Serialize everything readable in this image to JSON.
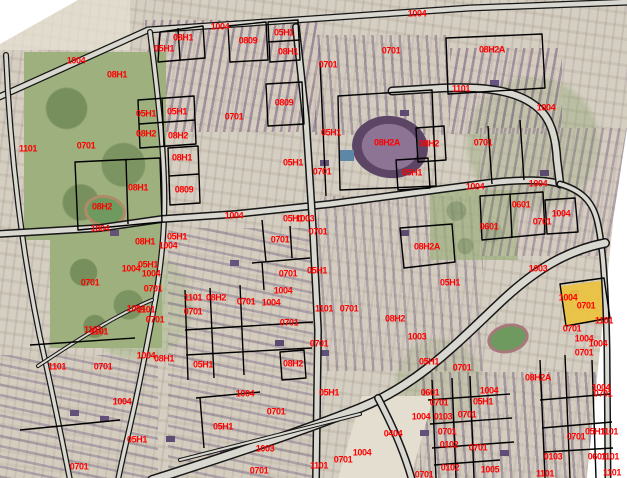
{
  "map": {
    "type": "cadastral-zoning-overlay-on-satellite",
    "background_color": "#ffffff",
    "label_color": "#ff0000",
    "boundary_color": "#000000",
    "road_fill_color": "#d9d8d0",
    "highlight_parcel": {
      "color": "#ecc23f",
      "labels_on_it": [
        "1004",
        "0701"
      ]
    },
    "landmarks": [
      {
        "name": "stadium-track",
        "desc": "purple running track oval"
      },
      {
        "name": "swimming-pool",
        "desc": "small blue pool"
      },
      {
        "name": "sports-field-west",
        "desc": "green field with tan track"
      },
      {
        "name": "sports-field-southeast",
        "desc": "green field with red track"
      },
      {
        "name": "photo-edge-white-wedges",
        "desc": "rotated imagery edges at top-left and right"
      }
    ],
    "zone_codes_present": [
      "0701",
      "05H1",
      "08H1",
      "08H2",
      "08H2A",
      "0809",
      "1004",
      "1101",
      "1003",
      "0601",
      "0102",
      "0103",
      "0404",
      "1005"
    ],
    "labels": [
      {
        "text": "1004",
        "x": 76,
        "y": 61
      },
      {
        "text": "08H1",
        "x": 117,
        "y": 75
      },
      {
        "text": "08H1",
        "x": 183,
        "y": 38
      },
      {
        "text": "05H1",
        "x": 164,
        "y": 49
      },
      {
        "text": "1004",
        "x": 220,
        "y": 27
      },
      {
        "text": "0809",
        "x": 248,
        "y": 41
      },
      {
        "text": "05H1",
        "x": 284,
        "y": 33
      },
      {
        "text": "08H1",
        "x": 288,
        "y": 52
      },
      {
        "text": "1004",
        "x": 417,
        "y": 14
      },
      {
        "text": "0701",
        "x": 328,
        "y": 65
      },
      {
        "text": "0701",
        "x": 391,
        "y": 51
      },
      {
        "text": "08H2A",
        "x": 492,
        "y": 50
      },
      {
        "text": "1101",
        "x": 461,
        "y": 89
      },
      {
        "text": "1004",
        "x": 546,
        "y": 108
      },
      {
        "text": "0809",
        "x": 284,
        "y": 103
      },
      {
        "text": "0701",
        "x": 234,
        "y": 117
      },
      {
        "text": "05H1",
        "x": 146,
        "y": 114
      },
      {
        "text": "05H1",
        "x": 177,
        "y": 112
      },
      {
        "text": "08H2",
        "x": 146,
        "y": 134
      },
      {
        "text": "08H2",
        "x": 178,
        "y": 136
      },
      {
        "text": "1101",
        "x": 28,
        "y": 149
      },
      {
        "text": "0701",
        "x": 86,
        "y": 146
      },
      {
        "text": "08H1",
        "x": 182,
        "y": 158
      },
      {
        "text": "05H1",
        "x": 331,
        "y": 133
      },
      {
        "text": "08H2A",
        "x": 387,
        "y": 143
      },
      {
        "text": "08H2",
        "x": 429,
        "y": 144
      },
      {
        "text": "0701",
        "x": 483,
        "y": 143
      },
      {
        "text": "05H1",
        "x": 412,
        "y": 173
      },
      {
        "text": "0701",
        "x": 322,
        "y": 172
      },
      {
        "text": "05H1",
        "x": 293,
        "y": 163
      },
      {
        "text": "08H1",
        "x": 138,
        "y": 188
      },
      {
        "text": "0809",
        "x": 184,
        "y": 190
      },
      {
        "text": "08H2",
        "x": 102,
        "y": 207
      },
      {
        "text": "1004",
        "x": 100,
        "y": 229
      },
      {
        "text": "05H1",
        "x": 177,
        "y": 237
      },
      {
        "text": "08H1",
        "x": 145,
        "y": 242
      },
      {
        "text": "1004",
        "x": 168,
        "y": 246
      },
      {
        "text": "1004",
        "x": 234,
        "y": 216
      },
      {
        "text": "05H1",
        "x": 293,
        "y": 219
      },
      {
        "text": "1003",
        "x": 305,
        "y": 219
      },
      {
        "text": "0701",
        "x": 318,
        "y": 232
      },
      {
        "text": "0701",
        "x": 280,
        "y": 240
      },
      {
        "text": "1004",
        "x": 475,
        "y": 187
      },
      {
        "text": "1004",
        "x": 538,
        "y": 184
      },
      {
        "text": "0601",
        "x": 521,
        "y": 205
      },
      {
        "text": "1004",
        "x": 561,
        "y": 214
      },
      {
        "text": "0701",
        "x": 542,
        "y": 222
      },
      {
        "text": "0601",
        "x": 489,
        "y": 227
      },
      {
        "text": "08H2A",
        "x": 427,
        "y": 247
      },
      {
        "text": "1003",
        "x": 538,
        "y": 269
      },
      {
        "text": "05H1",
        "x": 148,
        "y": 265
      },
      {
        "text": "1004",
        "x": 131,
        "y": 269
      },
      {
        "text": "1004",
        "x": 151,
        "y": 274
      },
      {
        "text": "0701",
        "x": 288,
        "y": 274
      },
      {
        "text": "05H1",
        "x": 317,
        "y": 271
      },
      {
        "text": "0701",
        "x": 90,
        "y": 283
      },
      {
        "text": "0701",
        "x": 153,
        "y": 289
      },
      {
        "text": "05H1",
        "x": 450,
        "y": 283
      },
      {
        "text": "1004",
        "x": 283,
        "y": 291
      },
      {
        "text": "1101",
        "x": 193,
        "y": 298
      },
      {
        "text": "08H2",
        "x": 216,
        "y": 298
      },
      {
        "text": "1004",
        "x": 568,
        "y": 298
      },
      {
        "text": "0701",
        "x": 246,
        "y": 302
      },
      {
        "text": "1004",
        "x": 271,
        "y": 303
      },
      {
        "text": "0701",
        "x": 586,
        "y": 306
      },
      {
        "text": "1101",
        "x": 324,
        "y": 309
      },
      {
        "text": "0701",
        "x": 349,
        "y": 309
      },
      {
        "text": "0701",
        "x": 193,
        "y": 312
      },
      {
        "text": "1004",
        "x": 136,
        "y": 309
      },
      {
        "text": "1101",
        "x": 146,
        "y": 310
      },
      {
        "text": "08H2",
        "x": 395,
        "y": 319
      },
      {
        "text": "0701",
        "x": 155,
        "y": 320
      },
      {
        "text": "1101",
        "x": 604,
        "y": 321
      },
      {
        "text": "0701",
        "x": 289,
        "y": 323
      },
      {
        "text": "1101",
        "x": 93,
        "y": 330
      },
      {
        "text": "1101",
        "x": 99,
        "y": 332
      },
      {
        "text": "0701",
        "x": 572,
        "y": 329
      },
      {
        "text": "1003",
        "x": 417,
        "y": 337
      },
      {
        "text": "1004",
        "x": 584,
        "y": 339
      },
      {
        "text": "1004",
        "x": 598,
        "y": 344
      },
      {
        "text": "0701",
        "x": 319,
        "y": 344
      },
      {
        "text": "0701",
        "x": 584,
        "y": 353
      },
      {
        "text": "1004",
        "x": 146,
        "y": 356
      },
      {
        "text": "08H1",
        "x": 164,
        "y": 359
      },
      {
        "text": "05H1",
        "x": 203,
        "y": 365
      },
      {
        "text": "08H2",
        "x": 293,
        "y": 364
      },
      {
        "text": "05H1",
        "x": 429,
        "y": 362
      },
      {
        "text": "1101",
        "x": 57,
        "y": 367
      },
      {
        "text": "0701",
        "x": 103,
        "y": 367
      },
      {
        "text": "0701",
        "x": 462,
        "y": 368
      },
      {
        "text": "08H2A",
        "x": 538,
        "y": 378
      },
      {
        "text": "1004",
        "x": 601,
        "y": 388
      },
      {
        "text": "0701",
        "x": 603,
        "y": 394
      },
      {
        "text": "05H1",
        "x": 329,
        "y": 393
      },
      {
        "text": "1004",
        "x": 245,
        "y": 394
      },
      {
        "text": "0601",
        "x": 430,
        "y": 393
      },
      {
        "text": "1004",
        "x": 489,
        "y": 391
      },
      {
        "text": "0701",
        "x": 439,
        "y": 403
      },
      {
        "text": "05H1",
        "x": 483,
        "y": 402
      },
      {
        "text": "1004",
        "x": 122,
        "y": 402
      },
      {
        "text": "0701",
        "x": 276,
        "y": 412
      },
      {
        "text": "1004",
        "x": 421,
        "y": 417
      },
      {
        "text": "0103",
        "x": 443,
        "y": 417
      },
      {
        "text": "0701",
        "x": 467,
        "y": 415
      },
      {
        "text": "05H1",
        "x": 223,
        "y": 427
      },
      {
        "text": "0404",
        "x": 393,
        "y": 434
      },
      {
        "text": "0701",
        "x": 447,
        "y": 432
      },
      {
        "text": "05H1",
        "x": 595,
        "y": 432
      },
      {
        "text": "1101",
        "x": 609,
        "y": 432
      },
      {
        "text": "0701",
        "x": 576,
        "y": 437
      },
      {
        "text": "05H1",
        "x": 137,
        "y": 440
      },
      {
        "text": "0102",
        "x": 449,
        "y": 445
      },
      {
        "text": "0701",
        "x": 478,
        "y": 448
      },
      {
        "text": "1003",
        "x": 265,
        "y": 449
      },
      {
        "text": "1004",
        "x": 362,
        "y": 453
      },
      {
        "text": "0103",
        "x": 553,
        "y": 457
      },
      {
        "text": "0601",
        "x": 597,
        "y": 457
      },
      {
        "text": "1101",
        "x": 610,
        "y": 457
      },
      {
        "text": "0701",
        "x": 343,
        "y": 460
      },
      {
        "text": "1101",
        "x": 319,
        "y": 466
      },
      {
        "text": "0102",
        "x": 450,
        "y": 468
      },
      {
        "text": "1005",
        "x": 490,
        "y": 470
      },
      {
        "text": "0701",
        "x": 79,
        "y": 467
      },
      {
        "text": "0701",
        "x": 259,
        "y": 471
      },
      {
        "text": "1101",
        "x": 612,
        "y": 473
      },
      {
        "text": "1101",
        "x": 545,
        "y": 474
      },
      {
        "text": "0701",
        "x": 424,
        "y": 475
      }
    ]
  }
}
